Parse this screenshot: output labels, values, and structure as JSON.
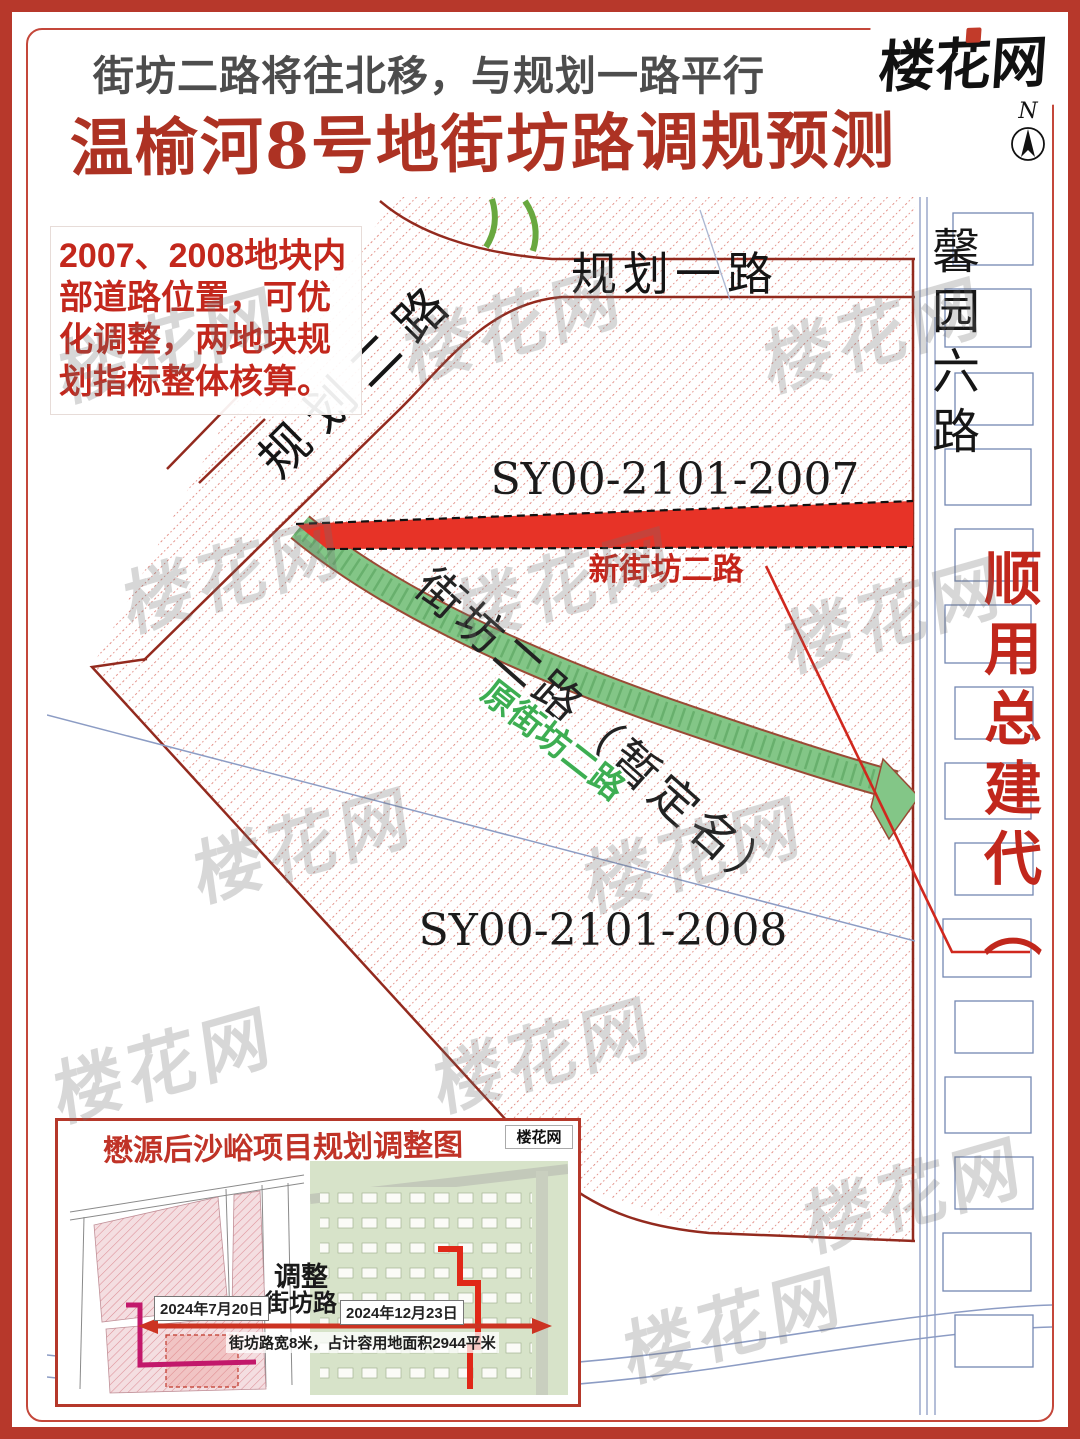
{
  "page": {
    "subtitle": "街坊二路将往北移，与规划一路平行",
    "title": "温榆河8号地街坊路调规预测",
    "logo": "楼花网",
    "compass_n": "N"
  },
  "note": {
    "text": "2007、2008地块内部道路位置，可优化调整，两地块规划指标整体核算。"
  },
  "map": {
    "labels": {
      "planned_road_1": "规划一路",
      "planned_road_2": "规划二路",
      "xinyuan_road_6": "馨园六路",
      "parcel_2007": "SY00-2101-2007",
      "parcel_2008": "SY00-2101-2008",
      "new_road": "新街坊二路",
      "old_road": "原街坊二路",
      "old_road_full": "街坊二路（暂定名）",
      "right_red_text": "顺用总建代（"
    }
  },
  "watermark": {
    "text": "楼花网"
  },
  "inset": {
    "title": "懋源后沙峪项目规划调整图",
    "logo": "楼花网",
    "adjust_line1": "调整",
    "adjust_line2": "街坊路",
    "date_left": "2024年7月20日",
    "date_right": "2024年12月23日",
    "caption": "街坊路宽8米，占计容用地面积2944平米"
  },
  "colors": {
    "outer_border": "#b7382b",
    "title_red": "#ad3223",
    "new_road_fill": "#e73327",
    "old_road_fill": "#83c687",
    "hatch_red": "#d96b60",
    "boundary_dark_red": "#932a1e",
    "blue_outline": "#7487b2",
    "note_red": "#c3271c",
    "vertical_red_text": "#c1271c"
  }
}
